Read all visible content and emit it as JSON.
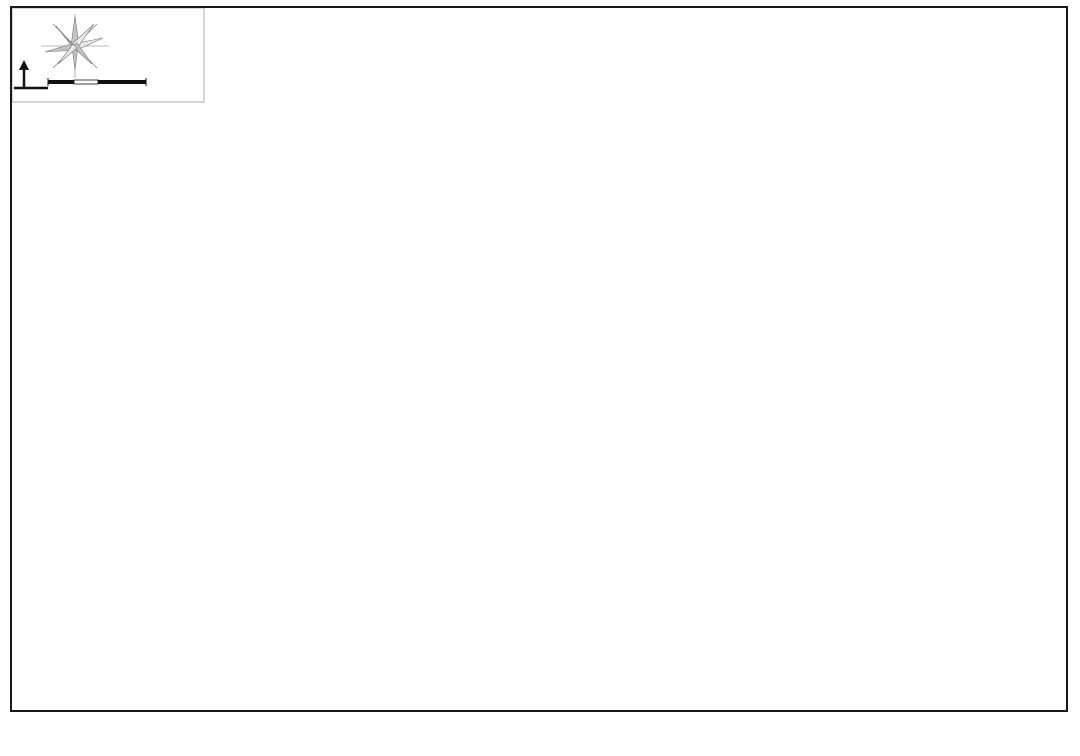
{
  "title": "九里亭街道行政区域图",
  "compass": {
    "north_label": "N",
    "scale_ticks": [
      "100",
      "200",
      "400m"
    ]
  },
  "map": {
    "palette": {
      "water": "#1d7de0",
      "boundary": "#e02828",
      "label_red": "#c4303a",
      "label_blue": "#2277cc"
    },
    "bg_blocks": [
      "215,12 610,12 575,120 250,135",
      "850,140 1070,80 1070,420 920,420",
      "560,640 1070,500 1070,750 600,750",
      "20,430 120,400 230,690 60,700"
    ],
    "roads_grey": [
      "M 618,8 L 648,95",
      "M 660,8 L 692,100",
      "M 998,60 L 1040,290",
      "M 950,300 L 1010,520"
    ],
    "regions": [
      {
        "id": "langting-shangjunyuan",
        "fill": "#dfa9c9",
        "stroke": "#c07792",
        "pts": "86,262 122,220 170,205 240,228 315,263 330,300 320,365 332,432 296,468 238,452 175,375 115,325",
        "labels": [
          {
            "t": "朗庭上郡苑",
            "x": 162,
            "y": 287
          },
          {
            "t": "颐亭花园",
            "x": 207,
            "y": 349
          }
        ]
      },
      {
        "id": "hongqiao-shoufu",
        "fill": "#ee7f9c",
        "stroke": "#c05570",
        "pts": "205,228 372,244 398,262 388,332 298,336 210,295",
        "labels": [
          {
            "t": "虹桥首府",
            "x": 267,
            "y": 264
          },
          {
            "t": "虹桥首府",
            "x": 307,
            "y": 314
          }
        ]
      },
      {
        "id": "yiyunjun-jinfeng",
        "fill": "#a9bae3",
        "stroke": "#7888b8",
        "pts": "286,172 506,86 540,198 455,232 430,280 330,262",
        "labels": [
          {
            "t": "依云郡",
            "x": 432,
            "y": 160
          },
          {
            "t": "金丰蓝庭",
            "x": 492,
            "y": 154
          },
          {
            "t": "金丰蓝庭",
            "x": 529,
            "y": 198
          },
          {
            "t": "金丰蓝庭",
            "x": 461,
            "y": 220
          }
        ]
      },
      {
        "id": "duxiang-xiaoqu",
        "fill": "#7e99b0",
        "stroke": "#8b3a4a",
        "pts": "506,86 558,72 648,208 540,198",
        "labels": [
          {
            "t": "金亭花苑",
            "x": 523,
            "y": 92
          },
          {
            "t": "杜巷小区",
            "x": 554,
            "y": 135
          },
          {
            "t": "杜巷小区",
            "x": 606,
            "y": 162
          }
        ]
      },
      {
        "id": "zhongda-jiulide",
        "fill": "#cbadda",
        "stroke": "#9f85b8",
        "pts": "292,206 432,162 458,240 404,264 340,256 300,242",
        "labels": [
          {
            "t": "中大九里德",
            "x": 362,
            "y": 209
          }
        ]
      },
      {
        "id": "zhongda-jiulide-2",
        "fill": "#c06cb8",
        "stroke": "#934f90",
        "pts": "344,240 402,230 418,292 362,302 336,272",
        "labels": [
          {
            "t": "中大",
            "x": 372,
            "y": 254
          },
          {
            "t": "九里德",
            "x": 370,
            "y": 268
          }
        ]
      },
      {
        "id": "jiuting-zhongxue-block",
        "fill": "#eadbb4",
        "stroke": "#c3ab76",
        "pts": "382,226 434,216 454,266 402,278",
        "labels": []
      },
      {
        "id": "zhicheng-huayuan",
        "fill": "#b7eee0",
        "stroke": "#6fbfa9",
        "pts": "452,233 615,200 650,253 492,287",
        "labels": [
          {
            "t": "志成花苑",
            "x": 553,
            "y": 255
          }
        ]
      },
      {
        "id": "huixiange-wuzhou",
        "fill": "#a9dcee",
        "stroke": "#6fa9c8",
        "pts": "360,295 420,280 490,287 590,264 614,320 520,347 432,369 376,338",
        "labels": [
          {
            "t": "汇贤阁",
            "x": 424,
            "y": 318
          },
          {
            "t": "五洲云景花苑",
            "x": 496,
            "y": 301
          }
        ]
      },
      {
        "id": "jiucheng-hubin",
        "fill": "#c7d09b",
        "stroke": "#96a25e",
        "pts": "586,265 652,247 700,342 642,374 598,330",
        "labels": [
          {
            "t": "九城湖滨",
            "x": 621,
            "y": 288
          },
          {
            "t": "国际公寓",
            "x": 618,
            "y": 302
          }
        ]
      },
      {
        "id": "beishangwan",
        "fill": "#f6d97a",
        "stroke": "#c8a544",
        "pts": "580,352 700,332 748,347 760,420 700,472 612,447 584,396",
        "labels": [
          {
            "t": "贝尚湾",
            "x": 652,
            "y": 367
          }
        ]
      },
      {
        "id": "aolinpike-bei",
        "fill": "#d9908f",
        "stroke": "#a33d44",
        "pts": "648,140 762,108 802,232 790,302 700,312 655,232",
        "labels": [
          {
            "t": "上海奥林匹克",
            "x": 710,
            "y": 256
          },
          {
            "t": "花园（北）",
            "x": 708,
            "y": 271
          }
        ]
      },
      {
        "id": "songhu-xiaoqu",
        "fill": "#eeaaa8",
        "stroke": "#c06664",
        "pts": "752,110 798,92 828,152 796,196 757,162",
        "labels": [
          {
            "t": "松沪",
            "x": 786,
            "y": 140
          },
          {
            "t": "小区",
            "x": 787,
            "y": 155
          }
        ]
      },
      {
        "id": "aolinpike-nan",
        "fill": "#da9960",
        "stroke": "#a6652f",
        "pts": "705,318 798,284 852,302 875,382 842,448 758,462 718,396",
        "labels": [
          {
            "t": "上海奥林匹克",
            "x": 780,
            "y": 320
          },
          {
            "t": "花园（南）",
            "x": 779,
            "y": 336
          }
        ]
      },
      {
        "id": "yinglun-moka",
        "fill": "#f8eeb2",
        "stroke": "#c8b86f",
        "pts": "322,342 392,318 432,330 452,400 448,448 380,462 330,420 310,375",
        "labels": [
          {
            "t": "英伦风尚",
            "x": 349,
            "y": 358
          },
          {
            "t": "摩卡小城",
            "x": 391,
            "y": 424
          }
        ]
      },
      {
        "id": "shanghai-gongguan-yuanhua",
        "fill": "#f2ba58",
        "stroke": "#c4852a",
        "pts": "205,368 322,340 352,420 432,520 420,568 340,560 260,480 205,430",
        "labels": [
          {
            "t": "上海公馆",
            "x": 283,
            "y": 382
          },
          {
            "t": "上海公馆",
            "x": 236,
            "y": 410
          },
          {
            "t": "上海源花城",
            "x": 319,
            "y": 459
          },
          {
            "t": "上海源花城",
            "x": 402,
            "y": 576
          }
        ]
      },
      {
        "id": "lvting-shangcheng",
        "fill": "#abdb89",
        "stroke": "#74a64c",
        "pts": "430,332 556,308 592,352 580,402 490,430 440,422 420,376",
        "labels": [
          {
            "t": "绿庭尚城",
            "x": 523,
            "y": 354
          },
          {
            "t": "绿庭尚城",
            "x": 460,
            "y": 379
          }
        ]
      },
      {
        "id": "jiuliting-xiaoqu",
        "fill": "#8ea8bf",
        "stroke": "#5f7b94",
        "pts": "295,455 420,430 500,438 650,455 672,520 640,600 560,650 468,674 380,656 308,592 283,510",
        "labels": [
          {
            "t": "九里亭小区",
            "x": 512,
            "y": 479
          },
          {
            "t": "九里亭花苑",
            "x": 512,
            "y": 616
          }
        ]
      },
      {
        "id": "tinghui-huayuan",
        "fill": "#92daa2",
        "stroke": "#55a06a",
        "pts": "540,512 612,496 652,532 640,602 572,616 530,572",
        "labels": [
          {
            "t": "亭汇花苑",
            "x": 587,
            "y": 557
          }
        ]
      },
      {
        "id": "cuiting-bieshu",
        "fill": "#92daa2",
        "stroke": "#55a06a",
        "pts": "480,582 540,574 548,604 492,614",
        "labels": [
          {
            "t": "翠亭别墅",
            "x": 513,
            "y": 595
          }
        ]
      }
    ],
    "white_blocks": [
      "718,226 778,211 792,273 732,287",
      "492,518 532,509 548,559 506,571",
      "505,376 572,365 588,431 520,443"
    ],
    "tan_blocks": [
      "520,386 560,379 572,425 532,432",
      "655,169 680,163 688,196 662,201",
      "690,131 718,123 724,149 696,156"
    ],
    "streets_white": [
      "M 385,98 C 420,190 455,300 480,390 C 495,440 505,480 512,520",
      "M 558,74 C 600,170 640,260 668,330",
      "M 238,232 C 280,330 330,440 370,540",
      "M 120,352 C 330,305 560,255 780,210",
      "M 150,425 C 360,378 600,325 830,280",
      "M 205,520 C 420,470 650,420 880,372",
      "M 258,608 C 470,556 690,505 900,455"
    ],
    "rivers": [
      {
        "d": "M 98,78 C 108,150 120,215 130,270 C 142,330 158,398 170,458 C 180,510 186,562 186,612 L 184,706",
        "w": 8
      },
      {
        "d": "M 100,170 C 130,158 150,175 175,168 C 200,161 205,145 228,148 C 252,151 262,168 252,185 C 245,198 260,208 282,206",
        "w": 5
      },
      {
        "d": "M 128,268 C 160,262 185,275 210,268 C 240,260 255,272 250,290 C 246,305 265,312 290,306 C 320,300 340,315 352,338 C 362,356 355,372 338,380",
        "w": 5
      },
      {
        "d": "M 51,282 C 250,238 500,184 700,148 C 745,140 780,132 820,127",
        "w": 8
      },
      {
        "d": "M 820,127 C 852,150 862,172 868,198 C 882,256 895,302 905,344 C 919,402 934,458 956,516 C 976,566 1000,620 1022,662",
        "w": 8
      },
      {
        "d": "M 745,8 C 748,32 753,54 763,74 C 773,94 792,110 814,124",
        "w": 6
      },
      {
        "d": "M 922,60 C 927,120 932,175 938,235 C 941,262 944,285 948,308",
        "w": 5
      },
      {
        "d": "M 384,8 L 402,52 C 408,68 413,82 418,96",
        "w": 6
      },
      {
        "d": "M 368,184 C 390,242 410,302 428,362 C 446,422 460,482 468,542 C 476,602 478,652 476,706",
        "w": 7
      },
      {
        "d": "M 252,340 C 275,412 298,482 318,552 C 330,594 340,642 346,692",
        "w": 6
      },
      {
        "d": "M 55,432 C 92,482 132,542 166,602 C 186,634 206,668 222,702",
        "w": 6
      },
      {
        "d": "M 330,756 C 450,700 560,660 680,622 C 800,580 920,542 1080,494",
        "w": 13
      },
      {
        "d": "M 588,642 C 596,680 602,718 606,752",
        "w": 6
      },
      {
        "d": "M 165,430 C 230,412 280,420 330,408 C 380,396 420,408 470,400 C 530,390 560,398 600,388 C 640,380 660,390 700,384",
        "w": 4
      }
    ],
    "lakes": [
      {
        "d": "M 596,328 C 608,306 600,290 618,284 C 636,278 632,300 652,294 C 670,289 664,310 686,312 C 696,313 700,302 696,292",
        "w": 4
      },
      {
        "d": "M 802,362 C 792,372 800,380 812,376",
        "w": 3
      }
    ],
    "lake_blobs": [
      {
        "cx": 818,
        "cy": 362,
        "rx": 16,
        "ry": 7
      },
      {
        "cx": 272,
        "cy": 408,
        "rx": 9,
        "ry": 6
      }
    ],
    "boundary": "M 37,218 L 160,180 L 300,142 L 420,105 L 462,92 L 560,64 L 600,75 L 648,95 L 672,88 L 700,78 L 742,60 L 762,55 L 800,92 L 830,108 L 850,140 L 862,200 L 880,260 L 900,320 L 912,380 L 880,420 L 840,460 L 800,490 L 740,530 L 700,555 L 620,580 L 510,607 L 420,635 L 330,662 L 262,680 L 225,640 L 195,580 L 165,510 L 130,430 L 95,345 L 60,270 Z",
    "water_labels": [
      {
        "t": "小区河",
        "x": 206,
        "y": 331
      },
      {
        "t": "小区河",
        "x": 598,
        "y": 219
      },
      {
        "t": "小区河",
        "x": 659,
        "y": 295
      },
      {
        "t": "小区河",
        "x": 823,
        "y": 353
      }
    ],
    "icons_circle": [
      {
        "t": "九里亭",
        "x": 532,
        "y": 115,
        "tx": 552,
        "ty": 118,
        "anchor": "start"
      },
      {
        "t": "亭北",
        "x": 478,
        "y": 139,
        "tx": 478,
        "ty": 128,
        "anchor": "middle"
      },
      {
        "t": "中大",
        "x": 348,
        "y": 222,
        "tx": 360,
        "ty": 225,
        "anchor": "start"
      },
      {
        "t": "五洲",
        "x": 464,
        "y": 284,
        "tx": 464,
        "ty": 298,
        "anchor": "middle"
      },
      {
        "t": "知雅汇",
        "x": 536,
        "y": 236,
        "tx": 549,
        "ty": 239,
        "anchor": "start"
      },
      {
        "t": "石里苑",
        "x": 306,
        "y": 298,
        "tx": 306,
        "ty": 289,
        "anchor": "middle"
      },
      {
        "t": "朗庭",
        "x": 198,
        "y": 364,
        "tx": 198,
        "ty": 355,
        "anchor": "middle"
      },
      {
        "t": "亭滨",
        "x": 368,
        "y": 332,
        "tx": 368,
        "ty": 345,
        "anchor": "middle"
      },
      {
        "t": "绿庭尚城",
        "x": 462,
        "y": 397,
        "tx": 462,
        "ty": 388,
        "anchor": "middle"
      },
      {
        "t": "贝尚湾",
        "x": 598,
        "y": 371,
        "tx": 610,
        "ty": 374,
        "anchor": "start"
      },
      {
        "t": "源黄",
        "x": 318,
        "y": 477,
        "tx": 329,
        "ty": 480,
        "anchor": "start"
      },
      {
        "t": "亭汇",
        "x": 548,
        "y": 526,
        "tx": 559,
        "ty": 529,
        "anchor": "start"
      },
      {
        "t": "北奥园",
        "x": 706,
        "y": 167,
        "tx": 717,
        "ty": 170,
        "anchor": "start"
      },
      {
        "t": "申奥园",
        "x": 786,
        "y": 418,
        "tx": 786,
        "ty": 409,
        "anchor": "middle"
      },
      {
        "t": "九城湖滨",
        "x": 637,
        "y": 320,
        "tx": 637,
        "ty": 311,
        "anchor": "middle"
      }
    ],
    "school_glyph": "文",
    "icons_school": [
      {
        "t": "九亭中学",
        "x": 406,
        "y": 249,
        "tx": 418,
        "ty": 252,
        "anchor": "start"
      },
      {
        "t": "九亭第三小学",
        "x": 663,
        "y": 181,
        "tx": 673,
        "ty": 184,
        "anchor": "start"
      },
      {
        "t": "九亭第三幼儿园",
        "x": 704,
        "y": 142,
        "tx": 712,
        "ty": 128,
        "anchor": "middle"
      },
      {
        "t": "九亭第四小学",
        "x": 552,
        "y": 403,
        "tx": 545,
        "ty": 392,
        "anchor": "middle"
      },
      {
        "t": "九亭第四幼儿园",
        "x": 554,
        "y": 429,
        "tx": 558,
        "ty": 420,
        "anchor": "middle"
      },
      {
        "t": "九亭第二幼儿园",
        "x": 447,
        "y": 413,
        "tx": 450,
        "ty": 426,
        "anchor": "middle"
      },
      {
        "t": "九亭小学",
        "x": 511,
        "y": 549,
        "tx": 513,
        "ty": 538,
        "anchor": "middle"
      }
    ],
    "star": {
      "x": 457,
      "y": 483,
      "lines": [
        "九里亭",
        "街道办事处"
      ],
      "lx": 462,
      "ly1": 499,
      "ly2": 512
    },
    "road_chars": [
      {
        "c": "涞",
        "x": 177,
        "y": 320
      },
      {
        "c": "九",
        "x": 305,
        "y": 358
      },
      {
        "c": "知",
        "x": 392,
        "y": 362
      },
      {
        "c": "亭",
        "x": 342,
        "y": 392
      },
      {
        "c": "北",
        "x": 527,
        "y": 266
      },
      {
        "c": "知",
        "x": 573,
        "y": 283
      },
      {
        "c": "越",
        "x": 470,
        "y": 462
      },
      {
        "c": "东",
        "x": 500,
        "y": 452
      },
      {
        "c": "亭",
        "x": 492,
        "y": 506
      },
      {
        "c": "富",
        "x": 516,
        "y": 500
      },
      {
        "c": "路",
        "x": 520,
        "y": 443
      },
      {
        "c": "安",
        "x": 442,
        "y": 535
      },
      {
        "c": "联",
        "x": 398,
        "y": 538
      },
      {
        "c": "茂",
        "x": 345,
        "y": 564
      },
      {
        "c": "盛",
        "x": 355,
        "y": 576
      },
      {
        "c": "洪",
        "x": 437,
        "y": 593
      },
      {
        "c": "路",
        "x": 453,
        "y": 603
      },
      {
        "c": "沪",
        "x": 320,
        "y": 500
      },
      {
        "c": "亭",
        "x": 328,
        "y": 516
      },
      {
        "c": "北",
        "x": 336,
        "y": 532
      },
      {
        "c": "路",
        "x": 344,
        "y": 548
      },
      {
        "c": "亭",
        "x": 875,
        "y": 205
      },
      {
        "c": "北",
        "x": 905,
        "y": 286
      },
      {
        "c": "路",
        "x": 915,
        "y": 320
      },
      {
        "c": "亭",
        "x": 495,
        "y": 58
      },
      {
        "c": "北",
        "x": 505,
        "y": 78
      },
      {
        "c": "路",
        "x": 770,
        "y": 430
      },
      {
        "c": "北",
        "x": 745,
        "y": 282
      },
      {
        "c": "泾",
        "x": 102,
        "y": 250
      },
      {
        "c": "路",
        "x": 610,
        "y": 465
      }
    ]
  }
}
